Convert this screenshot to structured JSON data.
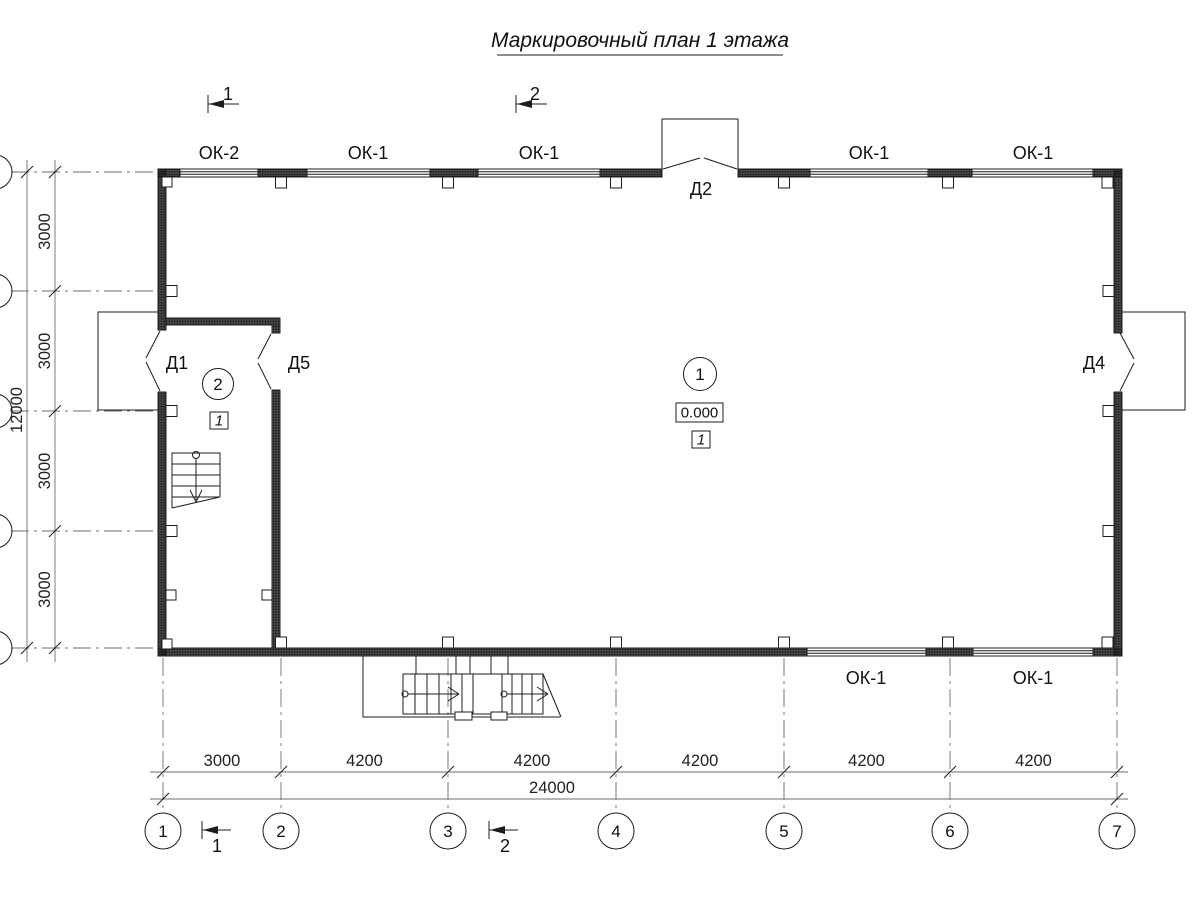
{
  "title": "Маркировочный план 1 этажа",
  "windows": {
    "top": [
      "ОК-2",
      "ОК-1",
      "ОК-1",
      "ОК-1",
      "ОК-1"
    ],
    "bottom": [
      "ОК-1",
      "ОК-1"
    ]
  },
  "doors": {
    "d1": "Д1",
    "d2": "Д2",
    "d4": "Д4",
    "d5": "Д5"
  },
  "rooms": {
    "hall": {
      "number": "1",
      "elevation": "0.000",
      "floor_type": "1"
    },
    "stair": {
      "number": "2",
      "floor_type": "1"
    }
  },
  "axes": {
    "bottom": [
      "1",
      "2",
      "3",
      "4",
      "5",
      "6",
      "7"
    ]
  },
  "dims": {
    "bottom_segments": [
      "3000",
      "4200",
      "4200",
      "4200",
      "4200",
      "4200"
    ],
    "bottom_total": "24000",
    "left_segments": [
      "3000",
      "3000",
      "3000",
      "3000"
    ],
    "left_total": "12000"
  },
  "sections": {
    "top": [
      "1",
      "2"
    ],
    "bottom": [
      "1",
      "2"
    ]
  },
  "colors": {
    "line": "#1c1c1c",
    "elevation_box_border": "#9a9a9a"
  }
}
